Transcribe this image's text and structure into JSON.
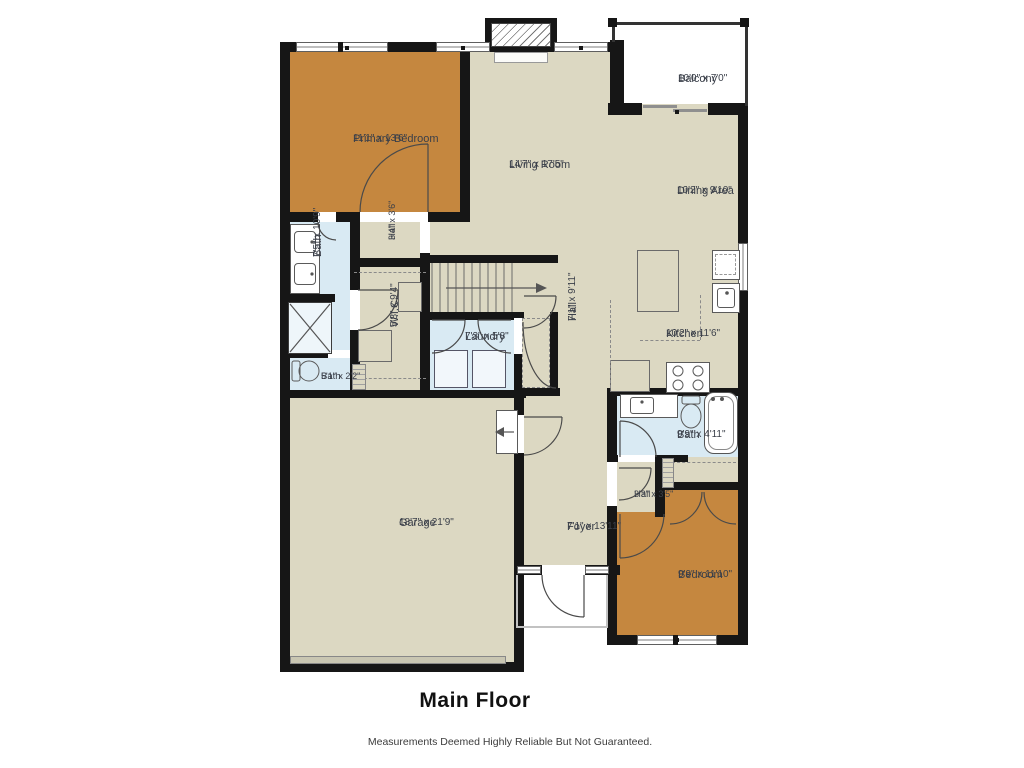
{
  "title": "Main Floor",
  "disclaimer": "Measurements Deemed Highly Reliable But Not Guaranteed.",
  "rooms": {
    "primary_bedroom": {
      "name": "Primary Bedroom",
      "dims": "11'1\" x 13'6\""
    },
    "living_room": {
      "name": "Living Room",
      "dims": "14'7\" x 17'5\""
    },
    "balcony": {
      "name": "Balcony",
      "dims": "10'0\" x 7'0\""
    },
    "dining_area": {
      "name": "Dining Area",
      "dims": "10'2\" x 9'10\""
    },
    "kitchen": {
      "name": "Kitchen",
      "dims": "10'2\" x 11'6\""
    },
    "bath_primary": {
      "name": "Bath",
      "dims": "7'5\" x 10'9\""
    },
    "hall_upper": {
      "name": "Hall",
      "dims": "3'4\" x 3'6\""
    },
    "wic": {
      "name": "W.I.C.",
      "dims": "5'8\" x 9'4\""
    },
    "laundry": {
      "name": "Laundry",
      "dims": "7'3\" x 5'8\""
    },
    "hall_center": {
      "name": "Hall",
      "dims": "7'1\" x 9'11\""
    },
    "bath_toilet": {
      "name": "Bath",
      "dims": "5'1\" x 2'2\""
    },
    "garage": {
      "name": "Garage",
      "dims": "18'7\" x 21'9\""
    },
    "foyer": {
      "name": "Foyer",
      "dims": "7'1\" x 13'11\""
    },
    "bath_second": {
      "name": "Bath",
      "dims": "9'9\" x 4'11\""
    },
    "hall_lower": {
      "name": "Hall",
      "dims": "3'3\" x 3'5\""
    },
    "bedroom": {
      "name": "Bedroom",
      "dims": "9'9\" x 11'10\""
    }
  },
  "colors": {
    "wall": "#161616",
    "floor": "#dcd8c2",
    "bedroom_floor": "#c5873f",
    "bath_floor": "#d9eaf3",
    "background": "#ffffff"
  }
}
